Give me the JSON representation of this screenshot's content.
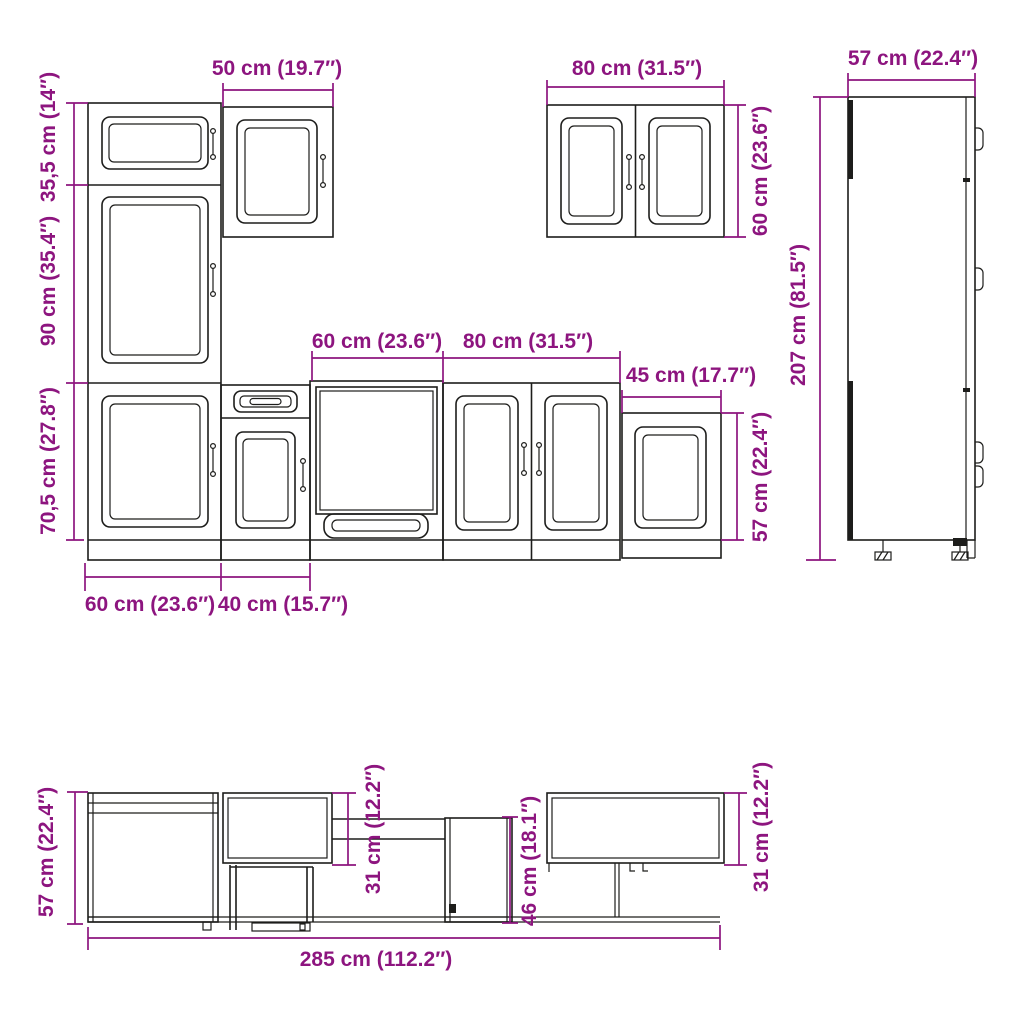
{
  "colors": {
    "dimension_text_and_lines": "#8d157f",
    "cabinet_outline": "#1d1d1b",
    "background": "#ffffff"
  },
  "front_view": {
    "tall_cabinet": {
      "top_height": "35,5 cm (14″)",
      "middle_height": "90 cm (35.4″)",
      "base_height": "70,5 cm (27.8″)",
      "width": "60 cm (23.6″)"
    },
    "wall_cabinet_50": {
      "width": "50 cm (19.7″)"
    },
    "base_cabinet_40": {
      "width": "40 cm (15.7″)"
    },
    "oven_cabinet_60": {
      "width": "60 cm (23.6″)"
    },
    "base_cabinet_80": {
      "width": "80 cm (31.5″)"
    },
    "wall_cabinet_45": {
      "width": "45 cm (17.7″)",
      "height": "57 cm (22.4″)"
    },
    "wall_cabinet_80": {
      "width": "80 cm (31.5″)",
      "height": "60 cm (23.6″)"
    },
    "tall_cabinet_side": {
      "depth": "57 cm (22.4″)",
      "height": "207 cm (81.5″)"
    }
  },
  "profile_view": {
    "base_height": "57 cm (22.4″)",
    "wall_cabinet_depth_mid": "31 cm (12.2″)",
    "clearance_height": "46 cm (18.1″)",
    "wall_cabinet_depth_right": "31 cm (12.2″)",
    "total_length": "285 cm (112.2″)"
  }
}
